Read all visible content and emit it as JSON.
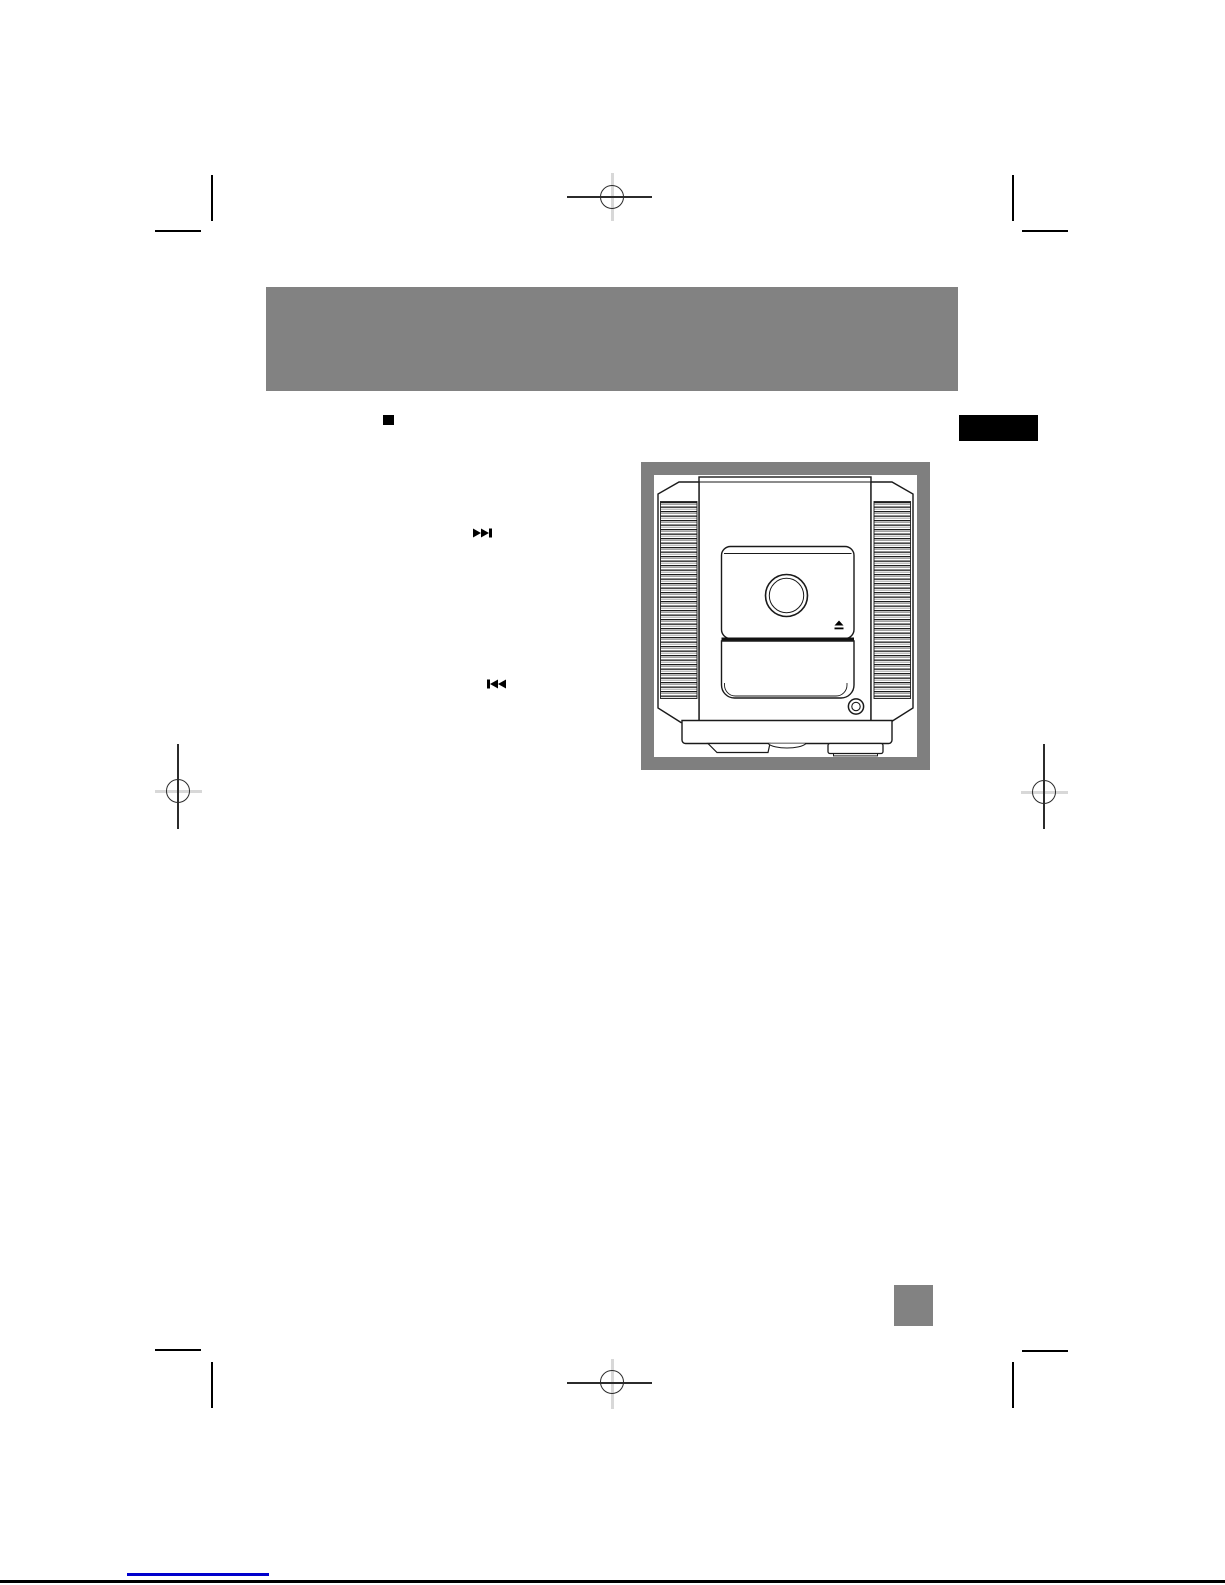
{
  "page": {
    "kind": "scanned-manual-page",
    "width_px": 1225,
    "height_px": 1585,
    "background_color": "#ffffff"
  },
  "header": {
    "title_bar": {
      "label": "",
      "color": "#828282"
    },
    "edge_tab": {
      "label": "",
      "color": "#000000"
    },
    "section_bullet": {
      "glyph": "■",
      "color": "#000000"
    }
  },
  "content": {
    "icons": [
      {
        "name": "next-track-icon",
        "glyph": "⏭"
      },
      {
        "name": "previous-track-icon",
        "glyph": "⏮"
      }
    ],
    "illustration": {
      "name": "mini-stereo-system-front-view",
      "frame_color": "#7f7f7f",
      "line_color": "#1a1a1a",
      "eject_icon_glyph": "⏏"
    }
  },
  "footer": {
    "page_number_box": {
      "label": "",
      "color": "#828282"
    },
    "link_underline_color": "#0000cc",
    "bottom_rule_color": "#000000"
  },
  "print_marks": {
    "crop_mark_color": "#000000",
    "registration_circle_color": "#2b2b2b",
    "registration_cross_light_color": "#d8d8d8"
  }
}
